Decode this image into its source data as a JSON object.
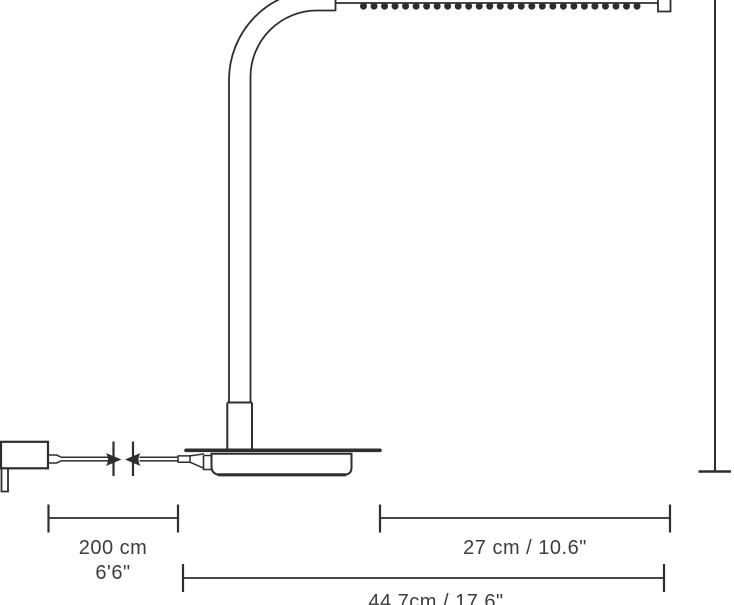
{
  "figure": {
    "type": "product-dimension-diagram",
    "subject": "desk lamp side elevation with LED head, base, power cable and adapter",
    "line_color": "#2e2e2e",
    "text_color": "#3d3d3d",
    "background": "#ffffff",
    "led_dot_count": 27
  },
  "dimensions": {
    "cable_metric": "200 cm",
    "cable_imperial": "6'6\"",
    "head_label": "27 cm / 10.6\"",
    "depth_label": "44.7cm / 17.6\""
  }
}
